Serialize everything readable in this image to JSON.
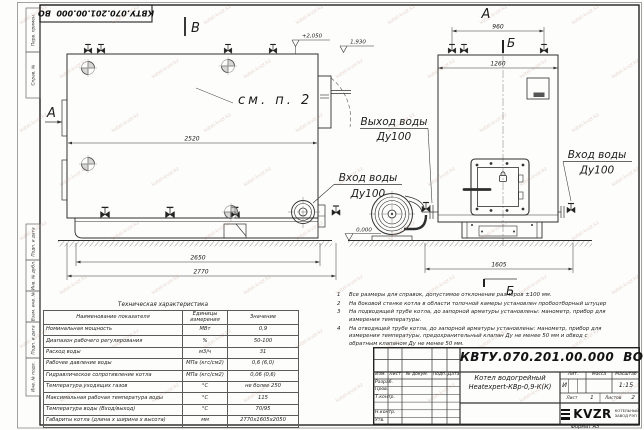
{
  "sheet": {
    "stamp_top": "КВТУ.070.201.00.000  ВО",
    "format_label": "Формат А3",
    "watermark": "kotel-kvzr.kz",
    "side_labels": [
      "Перв. примен.",
      "Справ. №",
      "Подп. и дата",
      "Инв. № дубл.",
      "Взам. инв. №",
      "Подп. и дата",
      "Инв. № подл."
    ]
  },
  "drawing": {
    "views": {
      "plan": "В",
      "front": "А",
      "side_arrow": "А",
      "section": "Б"
    },
    "elevations": {
      "top": "+2,050",
      "door": "1,930",
      "ground": "0,000"
    },
    "dimensions": {
      "side_length": "2520",
      "side_base": "2650",
      "side_overall": "2770",
      "front_valves": "960",
      "front_width": "1260",
      "front_base": "1605"
    },
    "callouts": {
      "see_note": "см. п. 2",
      "outlet_title": "Выход воды",
      "outlet_dn": "Ду100",
      "inlet_left_title": "Вход воды",
      "inlet_left_dn": "Ду100",
      "inlet_right_title": "Вход воды",
      "inlet_right_dn": "Ду100"
    }
  },
  "notes": {
    "items": [
      {
        "n": "1",
        "text": "Все размеры для справок, допустимое отклонение размеров ±100 мм."
      },
      {
        "n": "2",
        "text": "На боковой стенке котла в области топочной камеры установлен пробоотборный штуцер"
      },
      {
        "n": "3",
        "text": "На подводящей трубе котла, до запорной арматуры установлены: манометр, прибор для измерения температуры."
      },
      {
        "n": "4",
        "text": "На отводящей трубе котла, до запорной арматуры установлены: манометр, прибор для измерения температуры, предохранительный клапан Ду не менее 50 мм и обвод с обратным клапаном Ду не менее 50 мм."
      }
    ]
  },
  "spec_table": {
    "title": "Техническая характеристика",
    "headers": [
      "Наименование показателя",
      "Единицы измерения",
      "Значение"
    ],
    "rows": [
      [
        "Номинальная мощность",
        "МВт",
        "0,9"
      ],
      [
        "Диапазон рабочего регулирования",
        "%",
        "50-100"
      ],
      [
        "Расход воды",
        "м3/ч",
        "31"
      ],
      [
        "Рабочее давление воды",
        "МПа (кгс/см2)",
        "0,6 (6,0)"
      ],
      [
        "Гидравлическое сопротивление котла",
        "МПа (кгс/см2)",
        "0,06 (0,6)"
      ],
      [
        "Температура уходящих газов",
        "°С",
        "не более 250"
      ],
      [
        "Максимальная рабочая температура воды",
        "°С",
        "115"
      ],
      [
        "Температура воды (Вход/выход)",
        "°С",
        "70/95"
      ],
      [
        "Габариты котла (длина х ширина х высота)",
        "мм",
        "2770х1605х2050"
      ]
    ]
  },
  "title_block": {
    "designation": "КВТУ.070.201.00.000  ВО",
    "product_line1": "Котел водогрейный",
    "product_line2": "Heatexpert-КВр-0,9-К(К)",
    "header_cols": [
      "Изм.",
      "Лист",
      "№ докум.",
      "Подп.",
      "Дата"
    ],
    "sig_rows": [
      "Разраб.",
      "Пров.",
      "Т.контр.",
      "",
      "Н.контр.",
      "Утв."
    ],
    "lit_label": "Лит.",
    "lit_value": "И",
    "mass_label": "Масса",
    "mass_value": "",
    "scale_label": "Масштаб",
    "scale_value": "1:15",
    "sheet_label": "Лист",
    "sheet_value": "1",
    "sheets_label": "Листов",
    "sheets_value": "2",
    "company_name": "KVZR",
    "company_sub1": "КОТЕЛЬНЫЙ",
    "company_sub2": "ЗАВОД РЭП"
  }
}
